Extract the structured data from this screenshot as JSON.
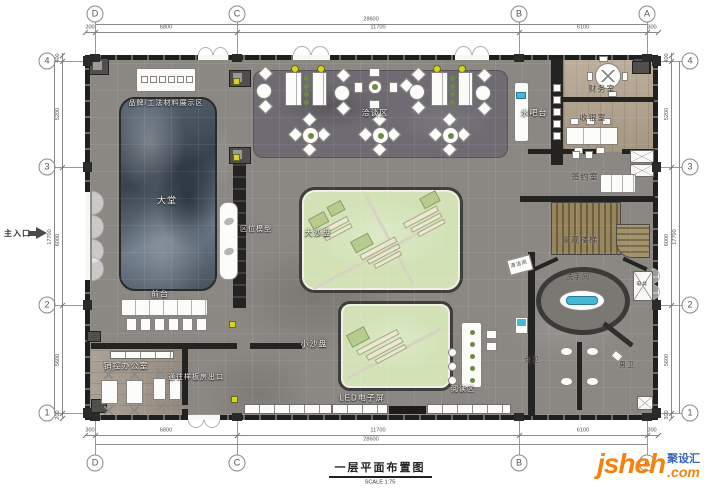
{
  "title_block": {
    "title": "一层平面布置图",
    "scale": "SCALE  1:75"
  },
  "watermark": {
    "logo": "jsheh",
    "tld": ".com",
    "badge": "聚设汇"
  },
  "entrance_label": "主入口",
  "grid": {
    "cols": [
      {
        "label": "D",
        "x": 95
      },
      {
        "label": "C",
        "x": 237
      },
      {
        "label": "B",
        "x": 519
      },
      {
        "label": "A",
        "x": 647
      }
    ],
    "rows": [
      {
        "label": "4",
        "y": 61
      },
      {
        "label": "3",
        "y": 167
      },
      {
        "label": "2",
        "y": 305
      },
      {
        "label": "1",
        "y": 413
      }
    ]
  },
  "dimensions": {
    "top": {
      "overall": "28600",
      "segments": [
        {
          "v": "300",
          "x": 90
        },
        {
          "v": "6800",
          "x": 166
        },
        {
          "v": "11700",
          "x": 378
        },
        {
          "v": "6100",
          "x": 583
        },
        {
          "v": "300",
          "x": 652
        }
      ]
    },
    "bottom": {
      "overall": "28600",
      "segments": [
        {
          "v": "300",
          "x": 90
        },
        {
          "v": "6800",
          "x": 166
        },
        {
          "v": "11700",
          "x": 378
        },
        {
          "v": "6100",
          "x": 583
        },
        {
          "v": "300",
          "x": 652
        }
      ]
    },
    "left": {
      "overall": "17700",
      "segments": [
        {
          "v": "400",
          "y": 58
        },
        {
          "v": "5200",
          "y": 114
        },
        {
          "v": "6000",
          "y": 240
        },
        {
          "v": "5600",
          "y": 360
        },
        {
          "v": "200",
          "y": 415
        }
      ]
    },
    "right": {
      "overall": "17700",
      "segments": [
        {
          "v": "400",
          "y": 58
        },
        {
          "v": "5200",
          "y": 114
        },
        {
          "v": "6000",
          "y": 240
        },
        {
          "v": "5600",
          "y": 360
        },
        {
          "v": "300",
          "y": 415
        }
      ]
    }
  },
  "rooms": [
    {
      "id": "brand-display",
      "label": "品牌/工法材料展示区",
      "x": 166,
      "y": 103,
      "fs": 7
    },
    {
      "id": "lobby",
      "label": "大堂",
      "x": 167,
      "y": 200,
      "fs": 9
    },
    {
      "id": "negotiation",
      "label": "洽谈区",
      "x": 375,
      "y": 113,
      "fs": 8
    },
    {
      "id": "water-bar",
      "label": "水吧台",
      "x": 534,
      "y": 113,
      "fs": 8
    },
    {
      "id": "finance",
      "label": "财务室",
      "x": 602,
      "y": 89,
      "fs": 8,
      "dark": true
    },
    {
      "id": "cashier",
      "label": "收银室",
      "x": 593,
      "y": 118,
      "fs": 8,
      "dark": true
    },
    {
      "id": "signing",
      "label": "签约室",
      "x": 585,
      "y": 177,
      "fs": 8,
      "dark": true
    },
    {
      "id": "landscape-stairs",
      "label": "景观楼梯",
      "x": 580,
      "y": 240,
      "fs": 8,
      "dark": true
    },
    {
      "id": "location-model",
      "label": "区位模型",
      "x": 256,
      "y": 229,
      "fs": 7
    },
    {
      "id": "big-sandtable",
      "label": "大沙盘",
      "x": 318,
      "y": 233,
      "fs": 8
    },
    {
      "id": "restroom",
      "label": "洗手间",
      "x": 578,
      "y": 277,
      "fs": 7,
      "dark": true
    },
    {
      "id": "front-desk",
      "label": "前台",
      "x": 160,
      "y": 294,
      "fs": 8
    },
    {
      "id": "small-sandtable",
      "label": "小沙盘",
      "x": 314,
      "y": 344,
      "fs": 8
    },
    {
      "id": "sales-office",
      "label": "销控办公室",
      "x": 126,
      "y": 366,
      "fs": 8
    },
    {
      "id": "model-exit",
      "label": "通往样板房出口",
      "x": 196,
      "y": 377,
      "fs": 7
    },
    {
      "id": "led-screen",
      "label": "LED电子屏",
      "x": 362,
      "y": 398,
      "fs": 8
    },
    {
      "id": "reading",
      "label": "阅读区",
      "x": 463,
      "y": 389,
      "fs": 7
    },
    {
      "id": "womens-wc",
      "label": "女卫",
      "x": 532,
      "y": 360,
      "fs": 7,
      "dark": true
    },
    {
      "id": "mens-wc",
      "label": "男卫",
      "x": 627,
      "y": 365,
      "fs": 7,
      "dark": true
    },
    {
      "id": "cleaning-room",
      "label": "清洁间",
      "x": 519,
      "y": 264,
      "fs": 5,
      "dark": true,
      "rot": -15
    },
    {
      "id": "elec-shaft",
      "label": "电井",
      "x": 642,
      "y": 284,
      "fs": 5,
      "dark": true
    }
  ]
}
